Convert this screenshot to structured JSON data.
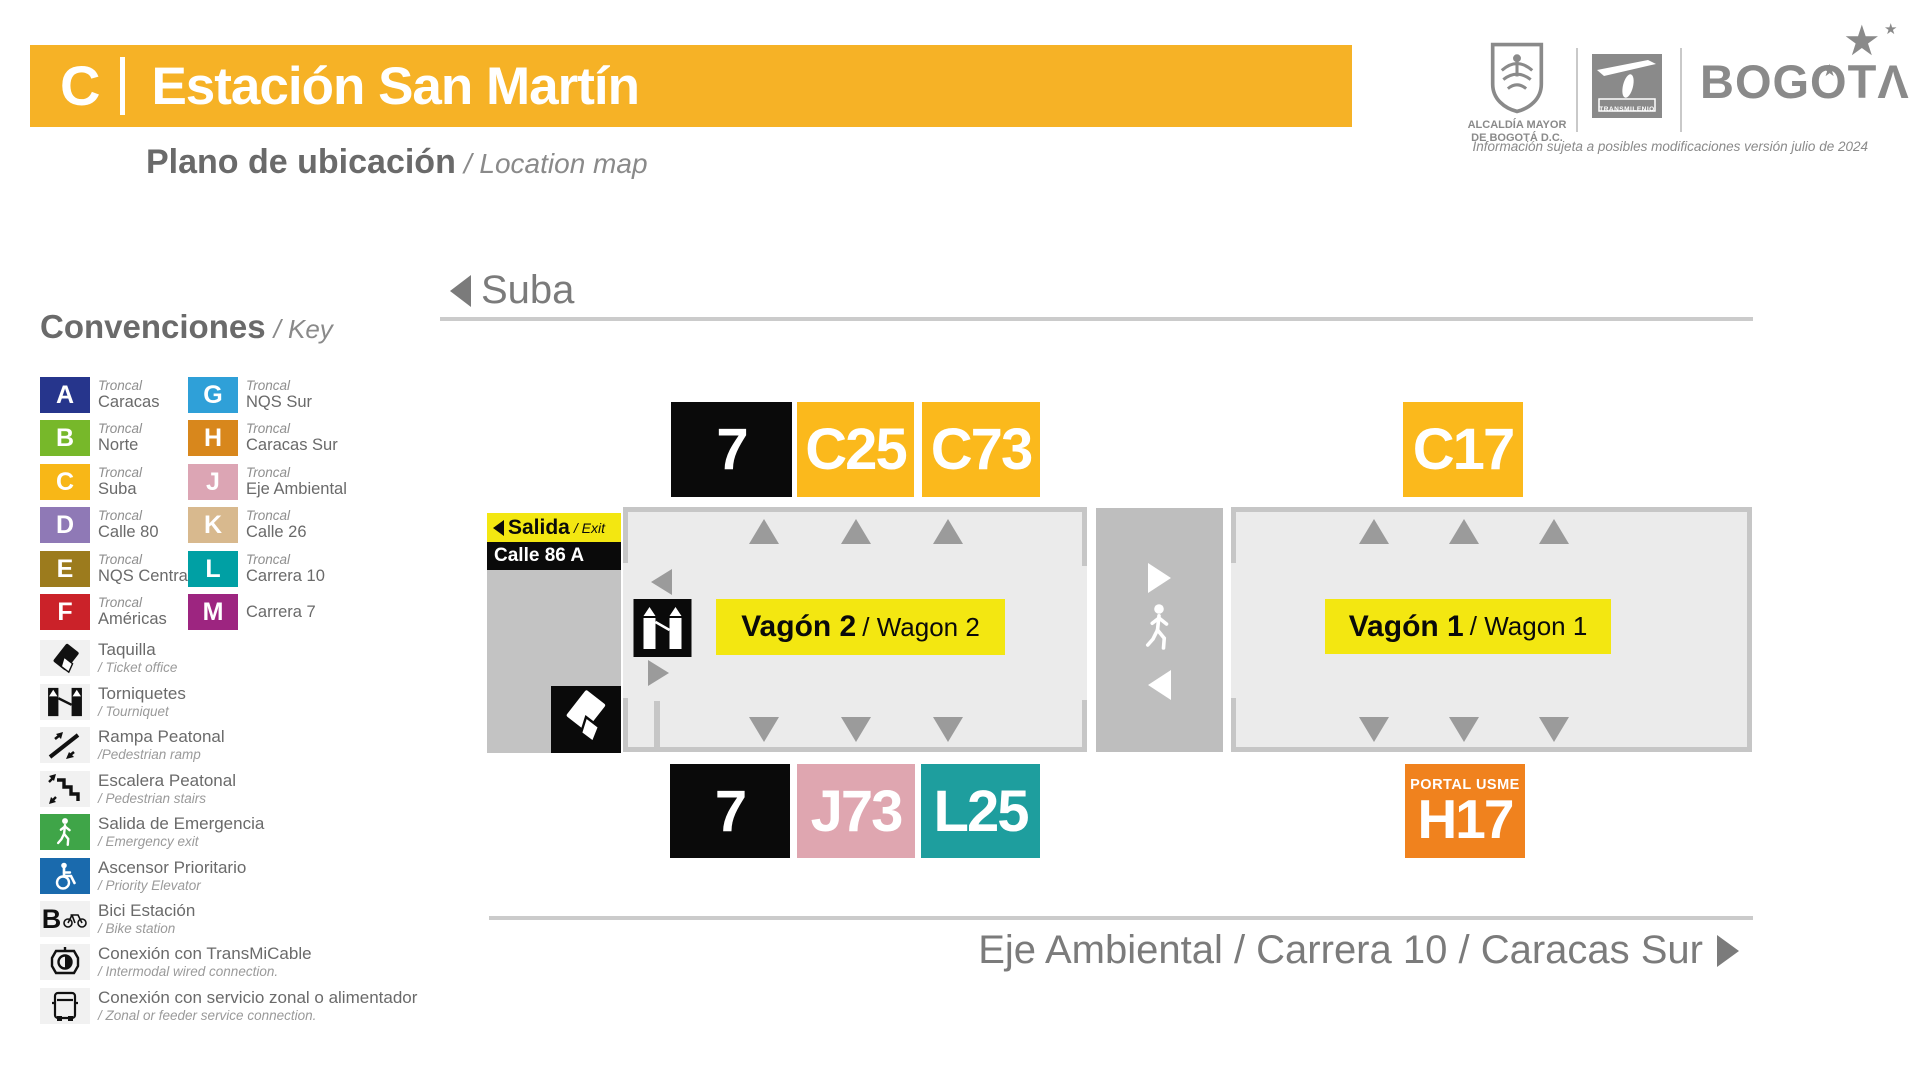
{
  "header": {
    "line_letter": "C",
    "station_name": "Estación San Martín",
    "subtitle_es": "Plano de ubicación",
    "subtitle_en": "/ Location map",
    "bar_color": "#F6B226",
    "disclaimer": "Información sujeta a posibles modificaciones versión julio de 2024"
  },
  "logos": {
    "alcaldia_line1": "ALCALDÍA MAYOR",
    "alcaldia_line2": "DE BOGOTÁ D.C.",
    "transmilenio": "TRANSMILENIO",
    "bogota_wordmark": "BOGOT",
    "bogota_a": "Λ",
    "star": "★"
  },
  "legend": {
    "title_es": "Convenciones",
    "title_en": "/ Key",
    "troncales": [
      {
        "letter": "A",
        "color": "#26358C",
        "line1": "Troncal",
        "line2": "Caracas"
      },
      {
        "letter": "B",
        "color": "#77B82A",
        "line1": "Troncal",
        "line2": "Norte"
      },
      {
        "letter": "C",
        "color": "#F8B717",
        "line1": "Troncal",
        "line2": "Suba"
      },
      {
        "letter": "D",
        "color": "#8F79B6",
        "line1": "Troncal",
        "line2": "Calle 80"
      },
      {
        "letter": "E",
        "color": "#9C7B1D",
        "line1": "Troncal",
        "line2": "NQS Central"
      },
      {
        "letter": "F",
        "color": "#CB2229",
        "line1": "Troncal",
        "line2": "Américas"
      },
      {
        "letter": "G",
        "color": "#2FA0D8",
        "line1": "Troncal",
        "line2": "NQS Sur"
      },
      {
        "letter": "H",
        "color": "#D8871C",
        "line1": "Troncal",
        "line2": "Caracas Sur"
      },
      {
        "letter": "J",
        "color": "#DCA5B4",
        "line1": "Troncal",
        "line2": "Eje Ambiental"
      },
      {
        "letter": "K",
        "color": "#D8B98E",
        "line1": "Troncal",
        "line2": "Calle 26"
      },
      {
        "letter": "L",
        "color": "#00A0A4",
        "line1": "Troncal",
        "line2": "Carrera 10"
      },
      {
        "letter": "M",
        "color": "#9D2580",
        "line1": "",
        "line2": "Carrera 7"
      }
    ],
    "icons": [
      {
        "icon": "taquilla-icon",
        "es": "Taquilla",
        "en": "/ Ticket office"
      },
      {
        "icon": "torniquetes-icon",
        "es": "Torniquetes",
        "en": "/ Tourniquet"
      },
      {
        "icon": "rampa-icon",
        "es": "Rampa Peatonal",
        "en": "/Pedestrian ramp"
      },
      {
        "icon": "escalera-icon",
        "es": "Escalera Peatonal",
        "en": "/ Pedestrian stairs"
      },
      {
        "icon": "salida-emergencia-icon",
        "es": "Salida de Emergencia",
        "en": "/ Emergency exit"
      },
      {
        "icon": "ascensor-icon",
        "es": "Ascensor Prioritario",
        "en": "/ Priority Elevator"
      },
      {
        "icon": "bici-icon",
        "es": "Bici Estación",
        "en": "/ Bike station"
      },
      {
        "icon": "transmicable-icon",
        "es": "Conexión con TransMiCable",
        "en": "/ Intermodal wired connection."
      },
      {
        "icon": "bus-icon",
        "es": "Conexión con servicio zonal o alimentador",
        "en": "/ Zonal or feeder service connection."
      }
    ]
  },
  "map": {
    "direction_top": "Suba",
    "direction_bottom": "Eje Ambiental / Carrera 10 / Caracas Sur",
    "exit": {
      "es": "Salida",
      "en": "/ Exit",
      "street": "Calle 86 A"
    },
    "wagon2": {
      "es": "Vagón 2",
      "en": "/ Wagon 2"
    },
    "wagon1": {
      "es": "Vagón 1",
      "en": "/ Wagon 1"
    },
    "top_badges": [
      {
        "label": "7",
        "bg": "#0A0A0A"
      },
      {
        "label": "C25",
        "bg": "#FBB91C"
      },
      {
        "label": "C73",
        "bg": "#FBB91C"
      }
    ],
    "top_right_badge": {
      "label": "C17",
      "bg": "#FBB91C"
    },
    "bottom_badges": [
      {
        "label": "7",
        "bg": "#0A0A0A"
      },
      {
        "label": "J73",
        "bg": "#DFA6B0"
      },
      {
        "label": "L25",
        "bg": "#1E9E9E"
      }
    ],
    "bottom_right_badge": {
      "label": "H17",
      "sublabel": "PORTAL USME",
      "bg": "#F0821E"
    },
    "colors": {
      "wagon_banner": "#F3E711",
      "station_fill": "#EBEBEB",
      "station_border": "#C6C6C6",
      "exit_zone": "#C3C3C3",
      "corridor": "#BEBEBE"
    }
  }
}
